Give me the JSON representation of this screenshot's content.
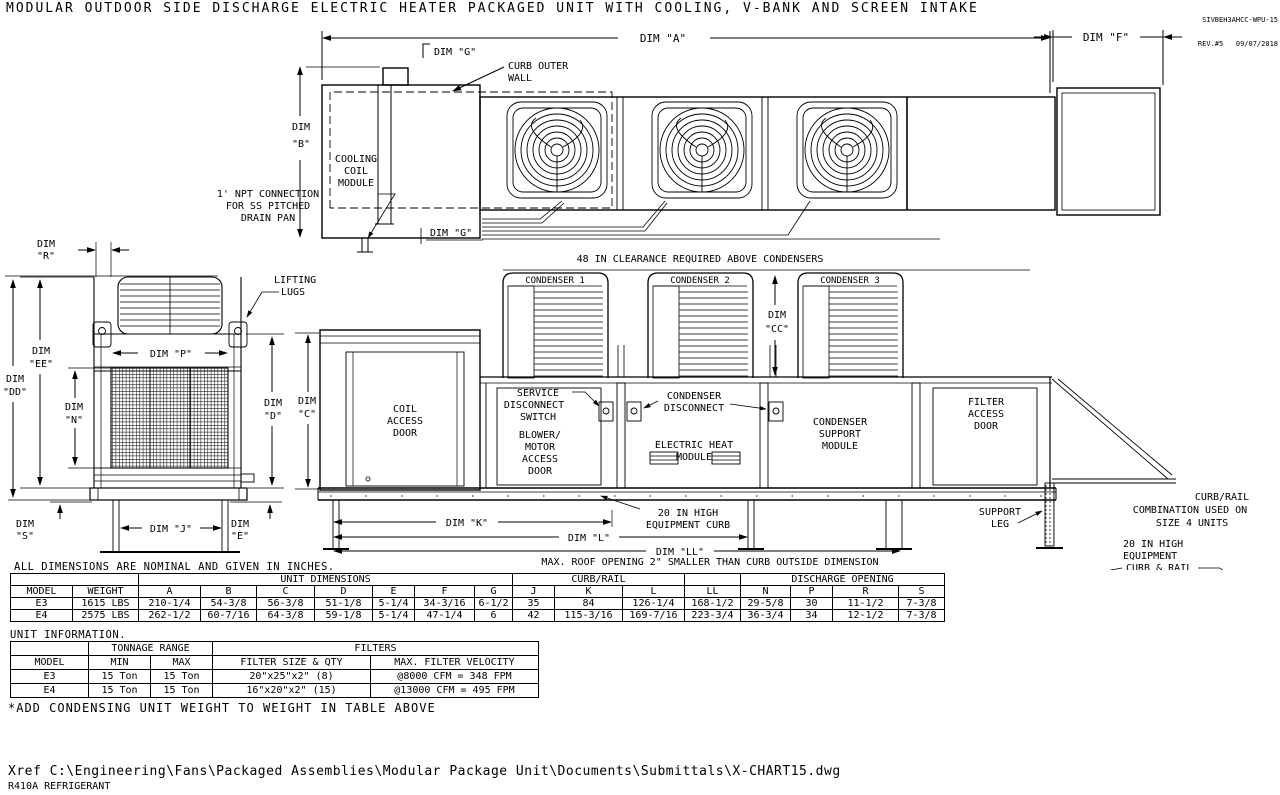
{
  "meta": {
    "title": "MODULAR OUTDOOR SIDE DISCHARGE ELECTRIC HEATER PACKAGED UNIT WITH COOLING, V-BANK AND SCREEN INTAKE",
    "drawing_id": "SIVBEH3AHCC-WPU-15",
    "revision": "REV.#5   09/07/2018"
  },
  "plan": {
    "dim_a": "DIM \"A\"",
    "dim_f": "DIM \"F\"",
    "dim_b": [
      "DIM",
      "\"B\""
    ],
    "dim_g_top": "DIM \"G\"",
    "dim_g_bottom": "DIM \"G\"",
    "curb_outer_wall": [
      "CURB OUTER",
      "WALL"
    ],
    "cooling_coil": [
      "COOLING",
      "COIL",
      "MODULE"
    ],
    "npt_note": [
      "1' NPT CONNECTION",
      "FOR SS PITCHED",
      "DRAIN PAN"
    ]
  },
  "elevation": {
    "clearance_note": "48 IN CLEARANCE REQUIRED ABOVE CONDENSERS",
    "condensers": [
      "CONDENSER 1",
      "CONDENSER 2",
      "CONDENSER 3"
    ],
    "dim_cc": [
      "DIM",
      "\"CC\""
    ],
    "dim_c": [
      "DIM",
      "\"C\""
    ],
    "coil_access_door": [
      "COIL",
      "ACCESS",
      "DOOR"
    ],
    "service_disconnect": [
      "SERVICE",
      "DISCONNECT",
      "SWITCH"
    ],
    "blower_door": [
      "BLOWER/",
      "MOTOR",
      "ACCESS",
      "DOOR"
    ],
    "condenser_disconnect": [
      "CONDENSER",
      "DISCONNECT"
    ],
    "electric_heat": [
      "ELECTRIC HEAT",
      "MODULE"
    ],
    "condenser_support": [
      "CONDENSER",
      "SUPPORT",
      "MODULE"
    ],
    "filter_access": [
      "FILTER",
      "ACCESS",
      "DOOR"
    ],
    "support_leg": [
      "SUPPORT",
      "LEG"
    ],
    "equipment_curb": [
      "20 IN HIGH",
      "EQUIPMENT CURB"
    ],
    "dim_k": "DIM \"K\"",
    "dim_l": "DIM \"L\"",
    "dim_ll": "DIM \"LL\"",
    "roof_note": "MAX. ROOF OPENING 2\" SMALLER THAN CURB OUTSIDE DIMENSION"
  },
  "end_view": {
    "dim_r": [
      "DIM",
      "\"R\""
    ],
    "lifting_lugs": [
      "LIFTING",
      "LUGS"
    ],
    "dim_p": "DIM \"P\"",
    "dim_n": [
      "DIM",
      "\"N\""
    ],
    "dim_ee": [
      "DIM",
      "\"EE\""
    ],
    "dim_dd": [
      "DIM",
      "\"DD\""
    ],
    "dim_d": [
      "DIM",
      "\"D\""
    ],
    "dim_s": [
      "DIM",
      "\"S\""
    ],
    "dim_e": [
      "DIM",
      "\"E\""
    ],
    "dim_j": "DIM \"J\""
  },
  "detail": {
    "curb_rail_note": [
      "CURB/RAIL",
      "COMBINATION USED ON",
      "SIZE 4 UNITS"
    ],
    "curb_rail_label": [
      "20 IN HIGH",
      "EQUIPMENT",
      "CURB & RAIL"
    ],
    "dim_j": "DIM \"J\"",
    "dim_k": "DIM \"K\""
  },
  "dim_table": {
    "note": "ALL DIMENSIONS ARE NOMINAL AND GIVEN IN INCHES.",
    "group_unit": "UNIT DIMENSIONS",
    "group_curb": "CURB/RAIL",
    "group_discharge": "DISCHARGE OPENING",
    "headers": [
      "MODEL",
      "WEIGHT",
      "A",
      "B",
      "C",
      "D",
      "E",
      "F",
      "G",
      "J",
      "K",
      "L",
      "LL",
      "N",
      "P",
      "R",
      "S"
    ],
    "rows": [
      [
        "E3",
        "1615 LBS",
        "210-1/4",
        "54-3/8",
        "56-3/8",
        "51-1/8",
        "5-1/4",
        "34-3/16",
        "6-1/2",
        "35",
        "84",
        "126-1/4",
        "168-1/2",
        "29-5/8",
        "30",
        "11-1/2",
        "7-3/8"
      ],
      [
        "E4",
        "2575 LBS",
        "262-1/2",
        "60-7/16",
        "64-3/8",
        "59-1/8",
        "5-1/4",
        "47-1/4",
        "6",
        "42",
        "115-3/16",
        "169-7/16",
        "223-3/4",
        "36-3/4",
        "34",
        "12-1/2",
        "7-3/8"
      ]
    ]
  },
  "info_table": {
    "caption": "UNIT INFORMATION.",
    "group_tonnage": "TONNAGE RANGE",
    "group_filters": "FILTERS",
    "headers": [
      "MODEL",
      "MIN",
      "MAX",
      "FILTER SIZE & QTY",
      "MAX. FILTER VELOCITY"
    ],
    "rows": [
      [
        "E3",
        "15 Ton",
        "15 Ton",
        "20\"x25\"x2\" (8)",
        "@8000 CFM = 348 FPM"
      ],
      [
        "E4",
        "15 Ton",
        "15 Ton",
        "16\"x20\"x2\" (15)",
        "@13000 CFM = 495 FPM"
      ]
    ],
    "footnote": "*ADD CONDENSING UNIT WEIGHT TO WEIGHT IN TABLE ABOVE"
  },
  "footer": {
    "xref": "Xref C:\\Engineering\\Fans\\Packaged Assemblies\\Modular Package Unit\\Documents\\Submittals\\X-CHART15.dwg",
    "refrigerant": "R410A REFRIGERANT"
  }
}
